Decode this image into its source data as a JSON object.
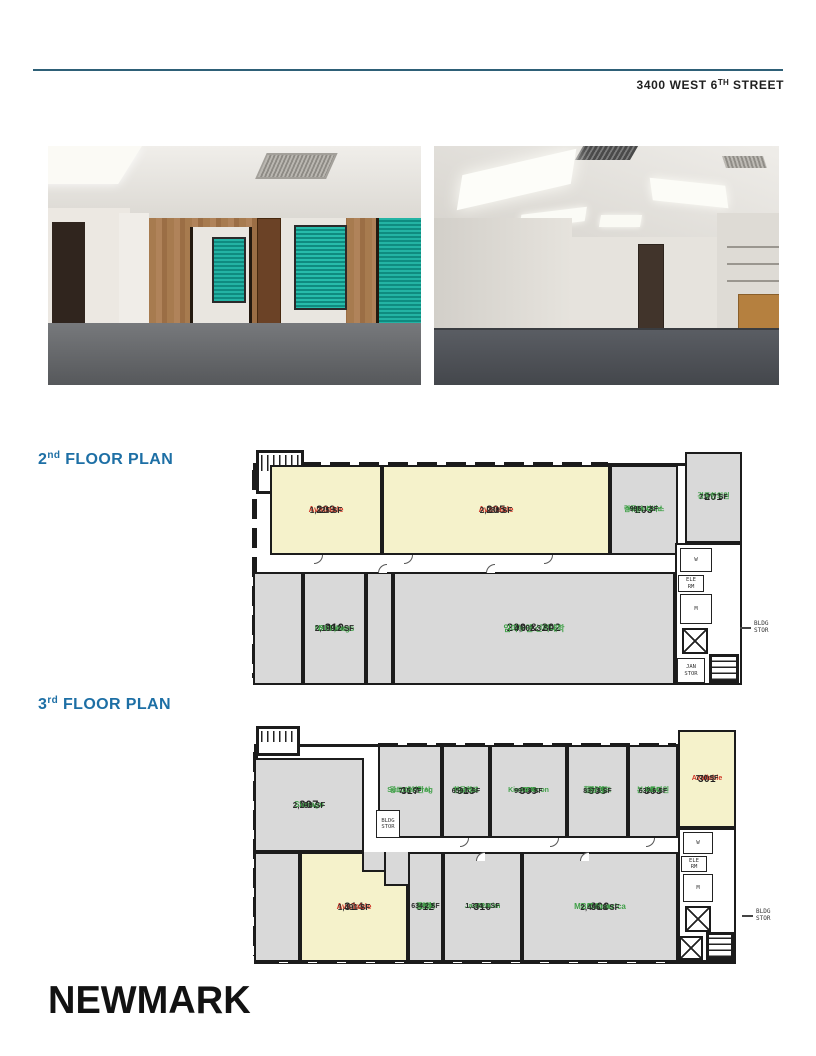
{
  "header": {
    "address_main": "3400 WEST 6",
    "address_sup": "TH",
    "address_tail": " STREET"
  },
  "floor2": {
    "heading_num": "2",
    "heading_sup": "nd",
    "heading_rest": " FLOOR PLAN",
    "rooms": {
      "r209": {
        "number": "209",
        "status": "Available",
        "sf": "1,325 SF"
      },
      "r205": {
        "number": "205",
        "status": "Available",
        "sf": "2,980 SF"
      },
      "r203": {
        "number": "203",
        "t1": "Mega-Com",
        "t2": "컴퓨터 서비스",
        "sf": "995.1 SF"
      },
      "r201": {
        "number": "201",
        "t1": "경동한의원",
        "sf": "717.7 SF"
      },
      "r210": {
        "number": "210",
        "t1": "Natterings",
        "t2": "SLP,Inc.",
        "sf": "2,199.2 SF"
      },
      "r200_202": {
        "number": "200 & 202",
        "t1": "임마누엘 신학대학",
        "sf": "4,602.3 SF"
      }
    },
    "small_labels": {
      "elec_rm": "ELEC\nRM",
      "women": "W",
      "ele_rm": "ELE\nRM",
      "men": "M",
      "jan_stor": "JAN\nSTOR",
      "bldg_stor": "BLDG\nSTOR"
    }
  },
  "floor3": {
    "heading_num": "3",
    "heading_sup": "rd",
    "heading_rest": " FLOOR PLAN",
    "rooms": {
      "r307": {
        "number": "307",
        "t1": "Storage",
        "sf": "2,190 SF"
      },
      "r317": {
        "number": "317",
        "t1": "Summer Frog",
        "t2": "광고 에이전시",
        "sf": "715 SF"
      },
      "r313": {
        "number": "313",
        "t1": "Hanuel",
        "t2": "한글학교",
        "sf": "659.5 SF"
      },
      "r309": {
        "number": "309",
        "t1": "Kim & Moon",
        "t2": "CPA",
        "sf": "991.8 SF"
      },
      "r305": {
        "number": "305",
        "t1": "힐링 핸드",
        "t2": "한의원",
        "sf": "837.8 SF"
      },
      "r303": {
        "number": "303",
        "t1": "MBC",
        "t2": "본사특파원",
        "sf": "632.6 SF"
      },
      "r301": {
        "number": "301",
        "status": "Available",
        "sf": "770 SF"
      },
      "r314": {
        "number": "314",
        "status": "Available",
        "sf": "1,491 SF"
      },
      "r312": {
        "number": "312",
        "t1": "CHA",
        "t2": "한방",
        "t3": "클리닉",
        "sf": "634.2 SF"
      },
      "r310": {
        "number": "310",
        "t1": "Jae C. Kim",
        "t2": "CPA",
        "sf": "1,334.1 SF"
      },
      "r300": {
        "number": "300",
        "t1": "MBC America",
        "t2": "Mstore",
        "sf": "2,496.8 SF"
      }
    },
    "small_labels": {
      "bldg_stor_box": "BLDG\nSTOR",
      "women": "W",
      "ele_rm": "ELE\nRM",
      "men": "M",
      "bldg_stor": "BLDG\nSTOR"
    }
  },
  "footer": {
    "logo": "NEWMARK"
  },
  "colors": {
    "available_fill": "#f5f2cb",
    "leased_fill": "#d9d9d9",
    "available_text": "#d03728",
    "tenant_text": "#3fa047",
    "heading_blue": "#1d6fa5",
    "wall": "#1c1c1c",
    "rule": "#2e6077"
  }
}
